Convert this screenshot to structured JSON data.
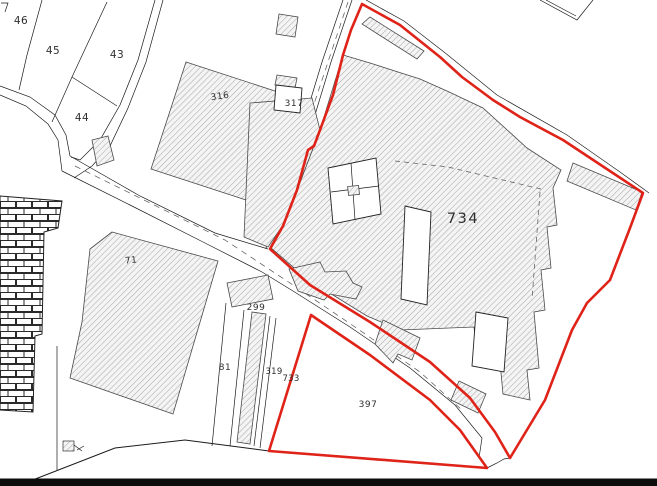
{
  "map": {
    "title": "cadastral plan extract",
    "labels": {
      "l46": "46",
      "l45": "45",
      "l43": "43",
      "l44": "44",
      "l316": "316",
      "l317": "317",
      "l734": "734",
      "l71": "71",
      "l299": "299",
      "l81": "81",
      "l319": "319",
      "l733": "733",
      "l397": "397"
    }
  },
  "colors": {
    "boundary_red": "#df2318",
    "hatch_line": "#a5a5a5",
    "hatch_fill": "#f4f4f4",
    "line_dark": "#1b1b1b",
    "label_color": "#2e2e2e",
    "footer_bar": "#0c0c0c"
  }
}
